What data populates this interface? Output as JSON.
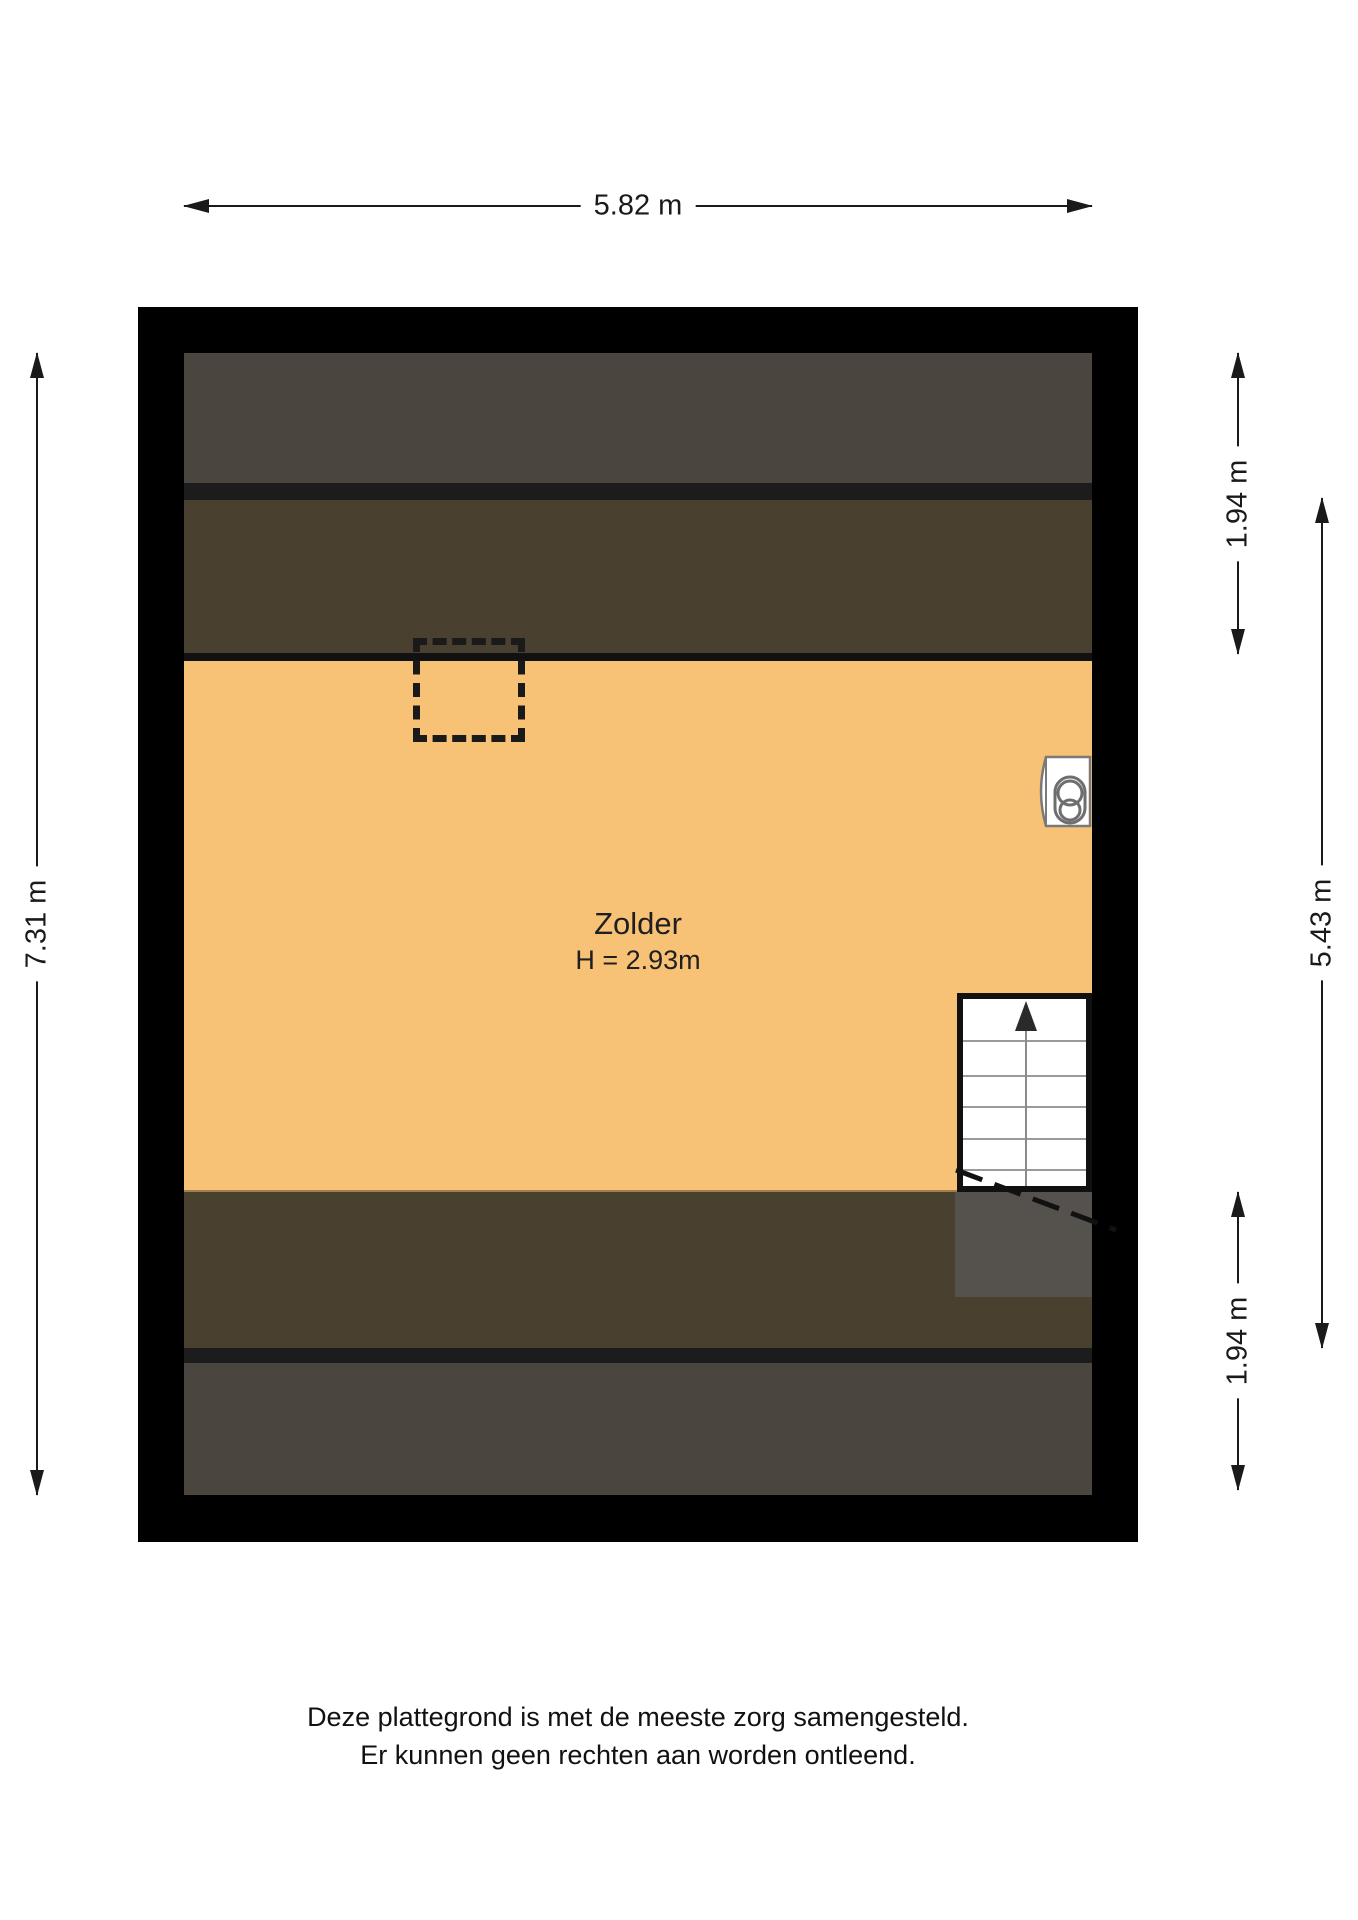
{
  "floorplan": {
    "room": {
      "name": "Zolder",
      "height_label": "H = 2.93m"
    },
    "dimensions": {
      "width_top": "5.82 m",
      "height_left": "7.31 m",
      "right_top": "1.94 m",
      "right_middle": "5.43 m",
      "right_bottom": "1.94 m"
    },
    "colors": {
      "wall": "#000000",
      "floor": "#f8c276",
      "roof_zone_outer": "#4a463f",
      "roof_zone_inner": "#4a4030",
      "knee_wall": "#1c1c1c",
      "stairs_shadow": "#55524d"
    },
    "icons": {
      "boiler": "boiler-icon",
      "stairs_direction": "up"
    }
  },
  "footer": {
    "line1": "Deze plattegrond is met de meeste zorg samengesteld.",
    "line2": "Er kunnen geen rechten aan worden ontleend."
  }
}
